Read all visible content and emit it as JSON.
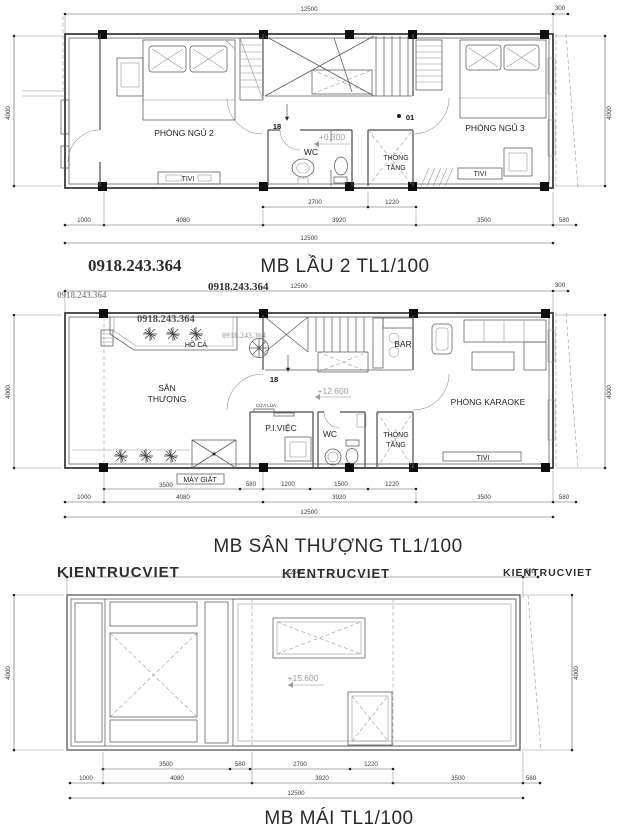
{
  "watermarks": {
    "phone": "0918.243.364",
    "brand": "KIENTRUCVIET",
    "color": "#6aa84f"
  },
  "floor2": {
    "title": "MB LẦU 2 TL1/100",
    "elevation": "+0.300",
    "stair_numbers": {
      "start": "18",
      "end": "01"
    },
    "rooms": {
      "bedroom2": "PHÒNG NGỦ 2",
      "bedroom3": "PHÒNG NGỦ 3",
      "wc": "WC",
      "void_line1": "THÔNG",
      "void_line2": "TẦNG",
      "tv_left": "TIVI",
      "tv_right": "TIVI"
    },
    "dims": {
      "top_total": "12500",
      "top_right": "300",
      "left_side": "4000",
      "right_side": "4000",
      "sub_row": [
        "2700",
        "1220"
      ],
      "main_row": [
        "1000",
        "4080",
        "3920",
        "3500",
        "580"
      ],
      "bottom_total": "12500"
    }
  },
  "terrace": {
    "title": "MB SÂN THƯỢNG  TL1/100",
    "elevation": "+12.600",
    "stair_number": "18",
    "rooms": {
      "fish_pond": "HỒ CÁ",
      "terrace_line1": "SÂN",
      "terrace_line2": "THƯỢNG",
      "bar": "BAR",
      "karaoke": "PHÒNG KARAOKE",
      "work": "P.I.VIỆC",
      "sliding_door": "CỬA LÙA",
      "wc": "WC",
      "void_line1": "THÔNG",
      "void_line2": "TẦNG",
      "laundry": "MÁY GIẶT",
      "tv": "TIVI"
    },
    "dims": {
      "top_total": "12500",
      "top_right": "300",
      "left_side": "4000",
      "right_side": "4000",
      "sub_row": [
        "3500",
        "580",
        "1200",
        "1500",
        "1220"
      ],
      "main_row": [
        "1000",
        "4080",
        "3920",
        "3500",
        "580"
      ],
      "bottom_total": "12500"
    }
  },
  "roof": {
    "title": "MB MÁI  TL1/100",
    "elevation": "+15.600",
    "dims": {
      "top_total": "12500",
      "top_right": "300",
      "left_side": "4000",
      "right_side": "4000",
      "sub_row": [
        "3500",
        "580",
        "2700",
        "1220"
      ],
      "main_row": [
        "1000",
        "4080",
        "3920",
        "3500",
        "580"
      ],
      "bottom_total": "12500"
    }
  }
}
